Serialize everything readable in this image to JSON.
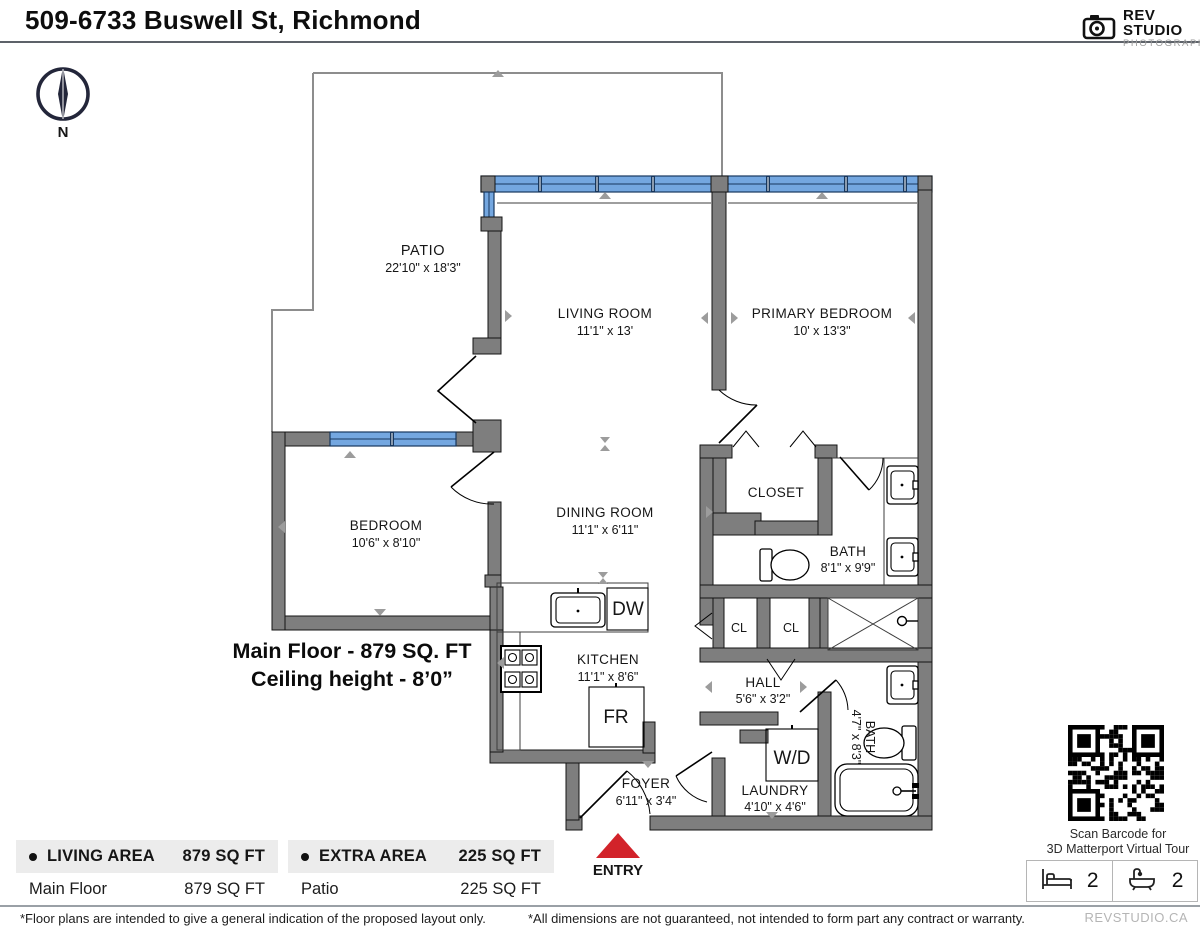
{
  "header": {
    "title": "509-6733 Buswell St, Richmond",
    "brand_name": "REV STUDIO",
    "brand_sub": "PHOTOGRAPHY"
  },
  "compass": {
    "north_label": "N"
  },
  "plan": {
    "rooms": {
      "patio": {
        "name": "PATIO",
        "dims": "22'10\" x 18'3\""
      },
      "living": {
        "name": "LIVING ROOM",
        "dims": "11'1\" x 13'"
      },
      "primary": {
        "name": "PRIMARY BEDROOM",
        "dims": "10' x 13'3\""
      },
      "bedroom": {
        "name": "BEDROOM",
        "dims": "10'6\" x 8'10\""
      },
      "dining": {
        "name": "DINING ROOM",
        "dims": "11'1\" x 6'11\""
      },
      "kitchen": {
        "name": "KITCHEN",
        "dims": "11'1\" x 8'6\""
      },
      "closet": {
        "name": "CLOSET"
      },
      "bath1": {
        "name": "BATH",
        "dims": "8'1\" x 9'9\""
      },
      "hall": {
        "name": "HALL",
        "dims": "5'6\" x 3'2\""
      },
      "bath2": {
        "name": "BATH",
        "dims": "4'7\" x 8'3\""
      },
      "foyer": {
        "name": "FOYER",
        "dims": "6'11\" x 3'4\""
      },
      "laundry": {
        "name": "LAUNDRY",
        "dims": "4'10\" x 4'6\""
      }
    },
    "fixtures": {
      "dw": "DW",
      "fr": "FR",
      "wd": "W/D",
      "cl1": "CL",
      "cl2": "CL"
    },
    "summary": {
      "line1": "Main Floor - 879 SQ. FT",
      "line2": "Ceiling height - 8’0”"
    },
    "entry_label": "ENTRY"
  },
  "area_tables": {
    "living": {
      "title": "LIVING AREA",
      "total": "879 SQ FT",
      "row_label": "Main Floor",
      "row_value": "879 SQ FT"
    },
    "extra": {
      "title": "EXTRA AREA",
      "total": "225 SQ FT",
      "row_label": "Patio",
      "row_value": "225 SQ FT"
    }
  },
  "sidebar": {
    "qr_caption1": "Scan Barcode for",
    "qr_caption2": "3D Matterport Virtual Tour",
    "beds": "2",
    "baths": "2"
  },
  "footer": {
    "disclaimer_left": "*Floor plans are intended to give a general indication of the proposed layout only.",
    "disclaimer_right": "*All dimensions are not guaranteed, not intended to form part any contract or warranty.",
    "brand": "REVSTUDIO.CA"
  },
  "colors": {
    "wall": "#7e7e7e",
    "window_blue": "#74a7e0",
    "entry_red": "#d2232a"
  }
}
